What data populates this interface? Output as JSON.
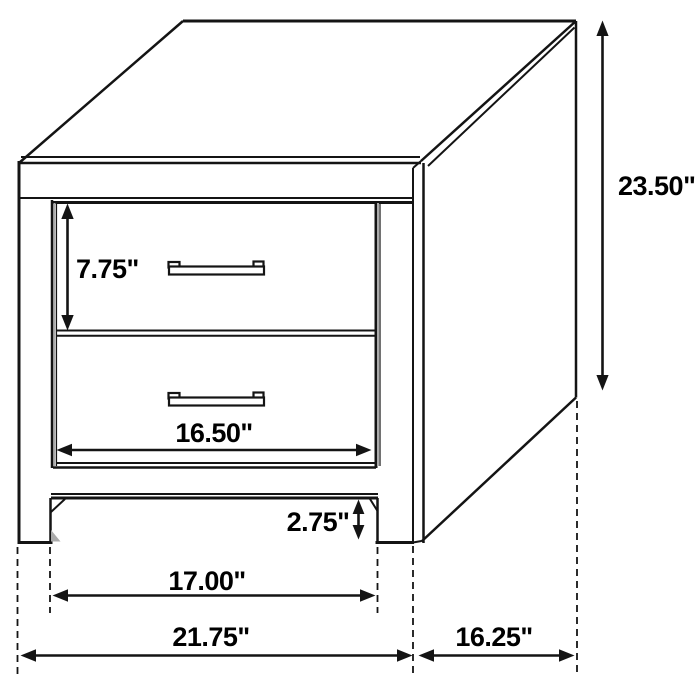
{
  "diagram": {
    "type": "furniture-dimension-diagram",
    "subject": "two-drawer nightstand line drawing with dimension callouts",
    "unit": "inches",
    "labels": {
      "overall_height": "23.50\"",
      "drawer_height": "7.75\"",
      "drawer_width": "16.50\"",
      "leg_clearance": "2.75\"",
      "between_legs_width": "17.00\"",
      "overall_width": "21.75\"",
      "overall_depth": "16.25\""
    },
    "colors": {
      "line": "#141414",
      "shade": "#ababab",
      "text": "#000000",
      "background": "#ffffff"
    }
  }
}
